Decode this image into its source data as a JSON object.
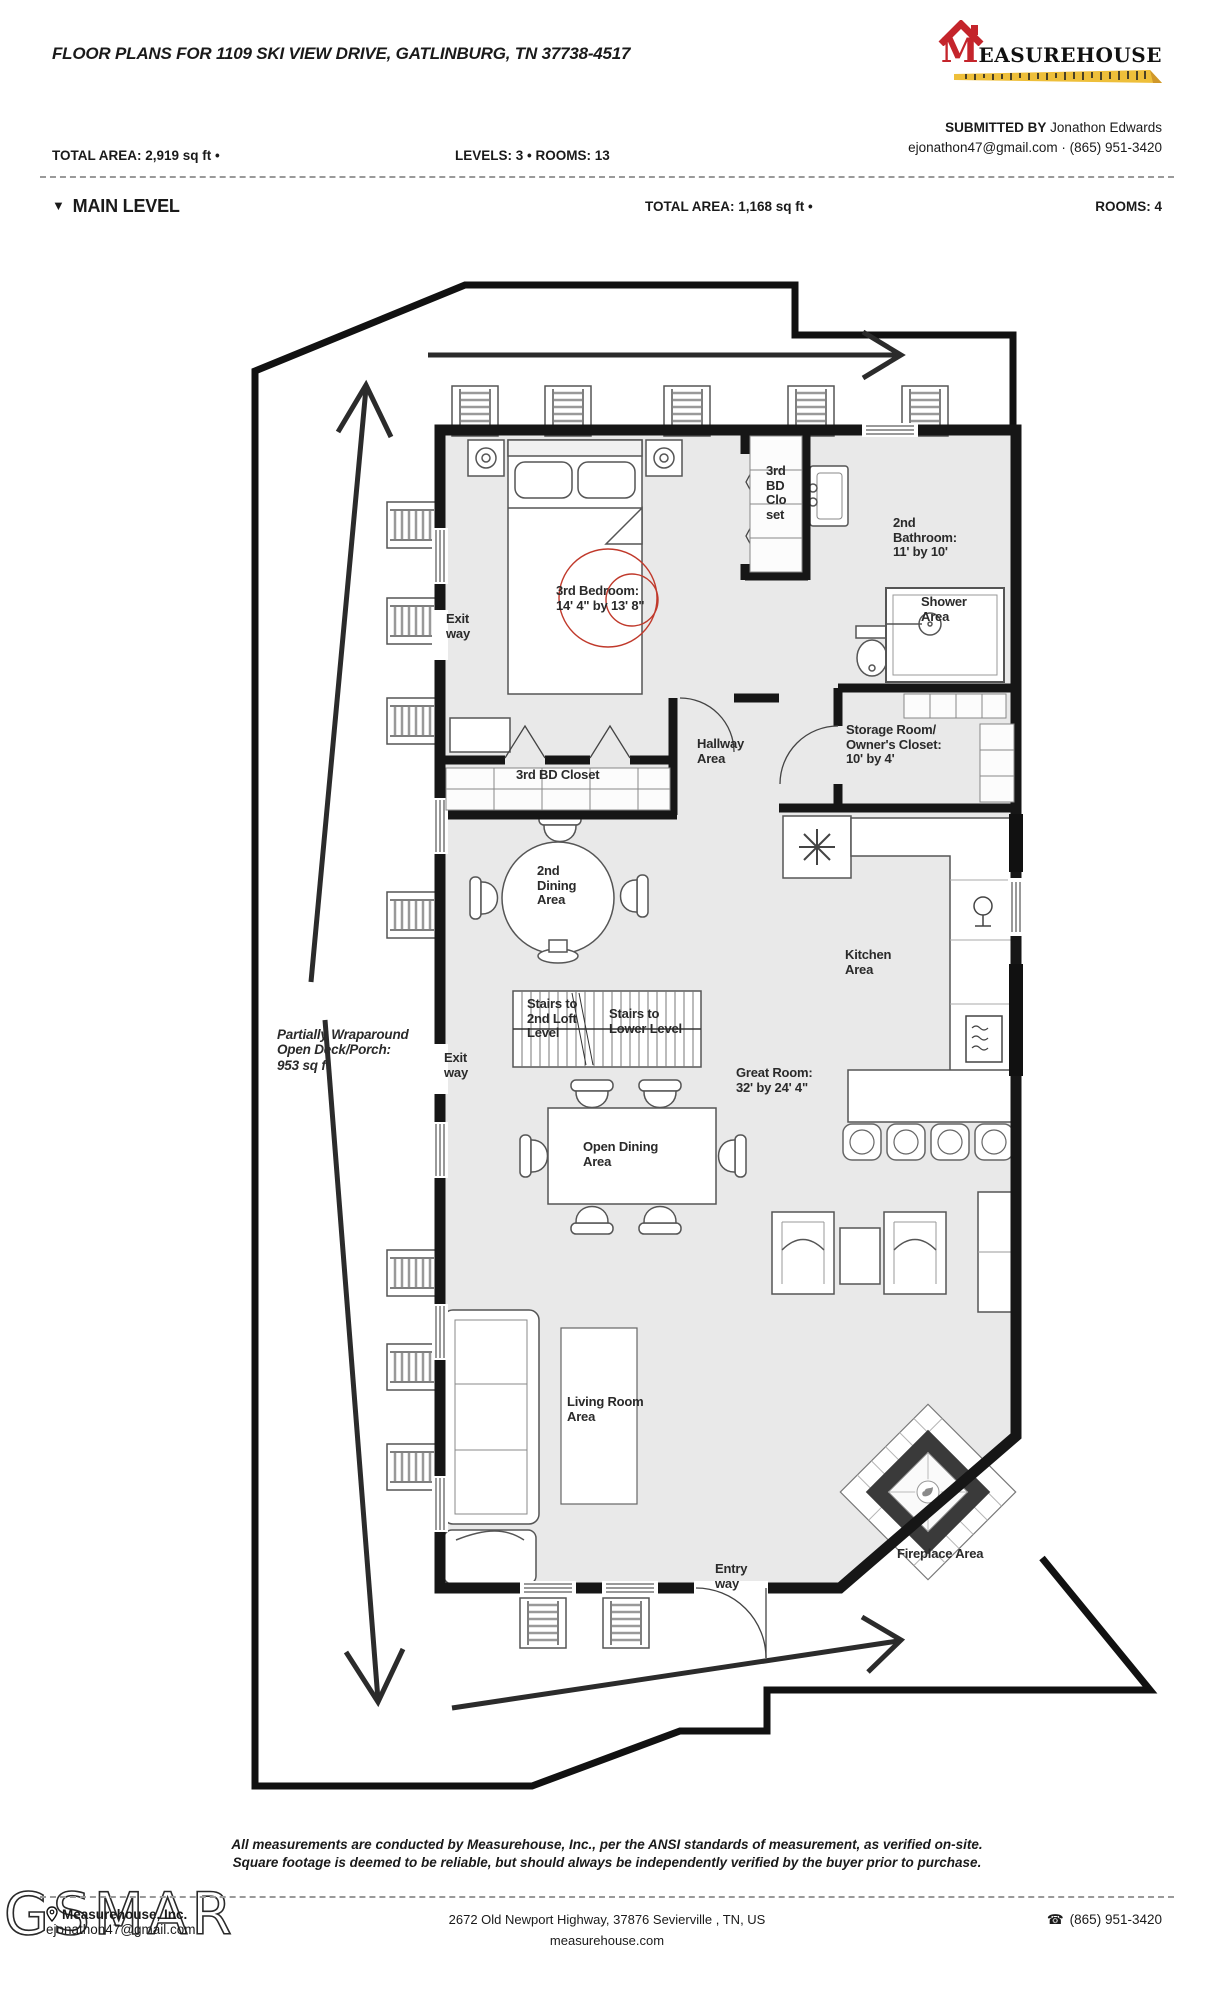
{
  "header": {
    "title": "FLOOR PLANS FOR 1109 SKI VIEW DRIVE, GATLINBURG, TN 37738-4517",
    "logo": {
      "m": "M",
      "rest": "EASUREHOUSE"
    },
    "submitted_by_label": "SUBMITTED BY",
    "submitted_by_name": " Jonathon Edwards",
    "contact_line": "ejonathon47@gmail.com · (865) 951-3420",
    "total_area": "TOTAL AREA: 2,919 sq ft •",
    "levels_rooms": "LEVELS: 3 • ROOMS: 13"
  },
  "level_header": {
    "collapse_icon": "▼",
    "name": "MAIN LEVEL",
    "total_area": "TOTAL AREA: 1,168 sq ft •",
    "rooms": "ROOMS: 4"
  },
  "plan_labels": {
    "bedroom3": "3rd Bedroom:\n14' 4\" by 13' 8\"",
    "bd_closet_column": "3rd\nBD\nClo\nset",
    "bathroom2": "2nd\nBathroom:\n11' by 10'",
    "shower": "Shower\nArea",
    "hallway": "Hallway\nArea",
    "storage": "Storage Room/\nOwner's Closet:\n10' by 4'",
    "bd_closet_strip": "3rd BD Closet",
    "dining2": "2nd\nDining\nArea",
    "kitchen": "Kitchen\nArea",
    "stairs_loft": "Stairs to\n2nd Loft\nLevel",
    "stairs_lower": "Stairs to\nLower Level",
    "great_room": "Great Room:\n32' by 24' 4\"",
    "open_dining": "Open Dining\nArea",
    "living_room": "Living Room\nArea",
    "fireplace": "Fireplace Area",
    "entry": "Entry\nway",
    "exit_upper": "Exit\nway",
    "exit_lower": "Exit\nway",
    "deck": "Partially Wraparound\nOpen Deck/Porch:\n953 sq ft"
  },
  "footer": {
    "disclaimer_line1": "All measurements are conducted by Measurehouse, Inc., per the ANSI standards of measurement, as verified on-site.",
    "disclaimer_line2": "Square footage is deemed to be reliable, but should always be independently verified by the buyer prior to purchase.",
    "watermark": "GSMAR",
    "company": "Measurehouse, Inc.",
    "email": "ejonathon47@gmail.com",
    "address": "2672 Old Newport Highway, 37876 Sevierville , TN, US",
    "website": "measurehouse.com",
    "phone": "(865) 951-3420"
  },
  "colors": {
    "accent_red": "#c4242b",
    "ruler_yellow": "#eebf3a",
    "wall": "#161616",
    "floor": "#e9e9e9",
    "camera_marker": "#c0392b"
  }
}
